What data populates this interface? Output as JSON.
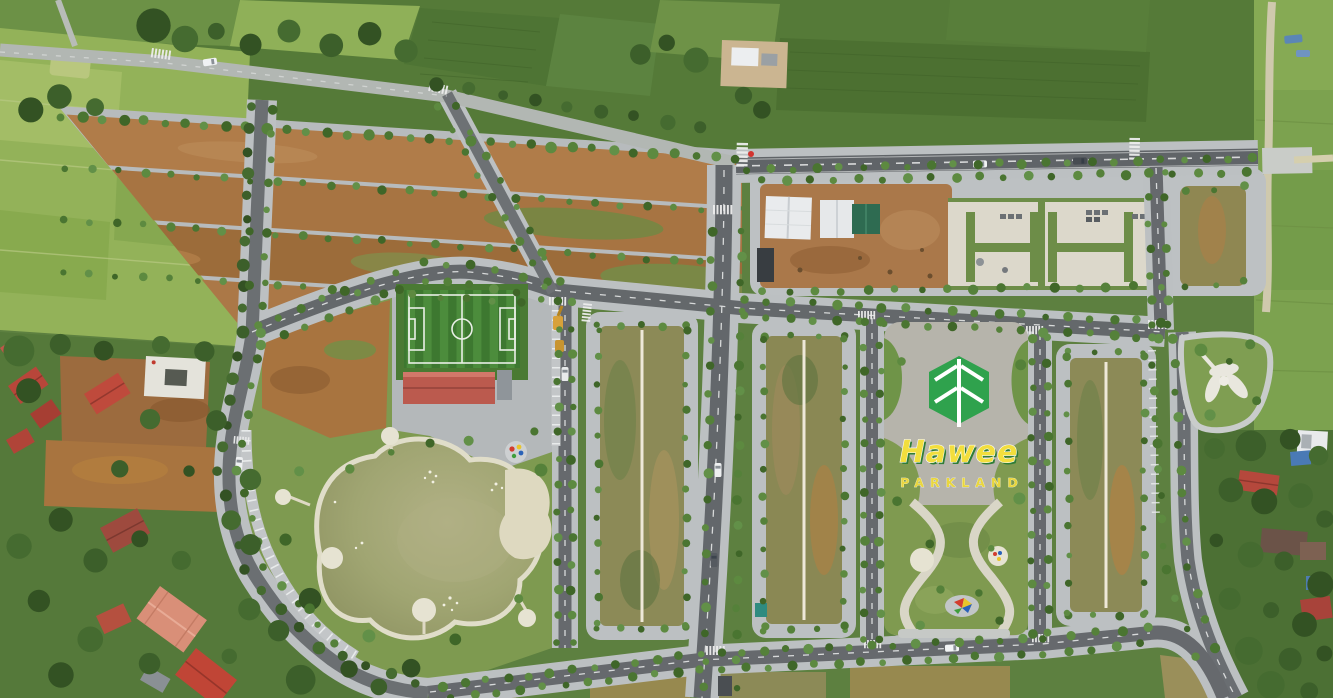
{
  "branding": {
    "name": "Hawee",
    "subtitle": "PARKLAND",
    "leaf_color": "#2fa24d",
    "name_color": "#f2de3d",
    "subtitle_color": "#e9d63e"
  },
  "palette": {
    "farmland_green": "#5d8040",
    "rice_paddy": "#93b259",
    "asphalt_road": "#63676b",
    "country_road": "#b2b7b3",
    "sidewalk": "#bcc0c2",
    "dirt_lot": "#ab7a49",
    "grass_lot": "#8c8a57",
    "lake_water": "#9da26e",
    "shore_path": "#ded9c4",
    "pitch_dark": "#3d7830",
    "pitch_light": "#4c8c3c",
    "roof_red": "#bb5a4e",
    "roof_salmon": "#d98f78",
    "concrete_slab": "#dcd8cb",
    "slab_grass_cut": "#6d8d48",
    "tree_green": "#4e7c33",
    "playground_red": "#d23c2e",
    "playground_yellow": "#e8c52c",
    "playground_blue": "#2a62b8"
  }
}
